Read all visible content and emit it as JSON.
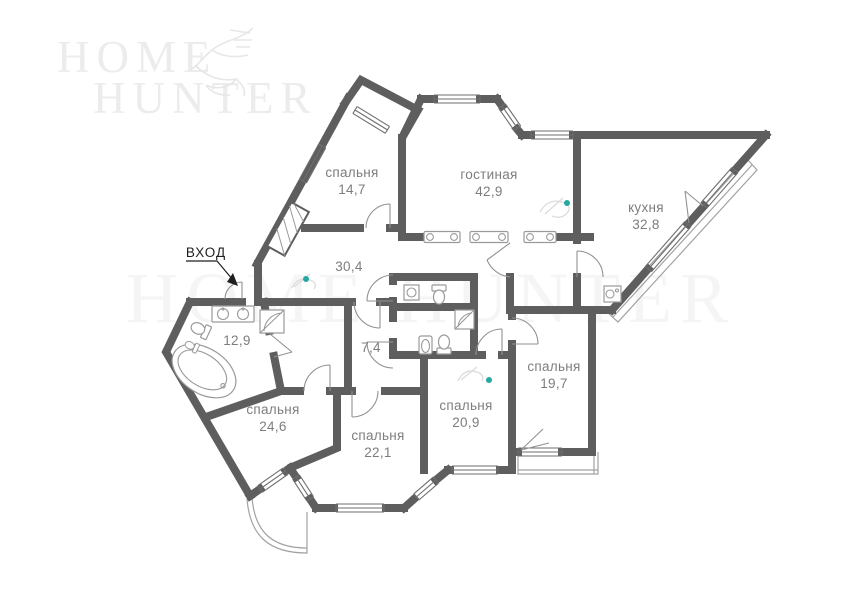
{
  "brand": {
    "line1": "HOME",
    "line2": "HUNTER",
    "logo_icon": "eagle-sketch",
    "logo_color": "#ececec"
  },
  "watermark": "HOME HUNTER",
  "entrance": {
    "label": "ВХОД"
  },
  "rooms": [
    {
      "key": "bedroom-top-left",
      "name": "спальня",
      "area": "14,7"
    },
    {
      "key": "living-room",
      "name": "гостиная",
      "area": "42,9"
    },
    {
      "key": "kitchen",
      "name": "кухня",
      "area": "32,8"
    },
    {
      "key": "hallway",
      "name": "",
      "area": "30,4"
    },
    {
      "key": "bathroom-left",
      "name": "",
      "area": "12,9"
    },
    {
      "key": "wc-central",
      "name": "",
      "area": "7,4"
    },
    {
      "key": "bedroom-left",
      "name": "спальня",
      "area": "24,6"
    },
    {
      "key": "bedroom-bottom-center",
      "name": "спальня",
      "area": "22,1"
    },
    {
      "key": "bedroom-center-right",
      "name": "спальня",
      "area": "20,9"
    },
    {
      "key": "bedroom-right",
      "name": "спальня",
      "area": "19,7"
    }
  ],
  "colors": {
    "walls": "#5e5e5e",
    "fixtures": "#9a9a9a",
    "labels": "#7d7d7d",
    "entrance_text": "#1f1f1f",
    "accent_dot": "#25a8a2",
    "logo": "#ececec"
  },
  "icons": [
    "bathtub-icon",
    "toilet-icon",
    "bidet-icon",
    "double-sink-icon",
    "shower-icon",
    "washer-icon",
    "stove-icon",
    "radiator-icon",
    "wardrobe-icon",
    "ceiling-light-dot",
    "entrance-arrow-icon",
    "eagle-sketch"
  ]
}
